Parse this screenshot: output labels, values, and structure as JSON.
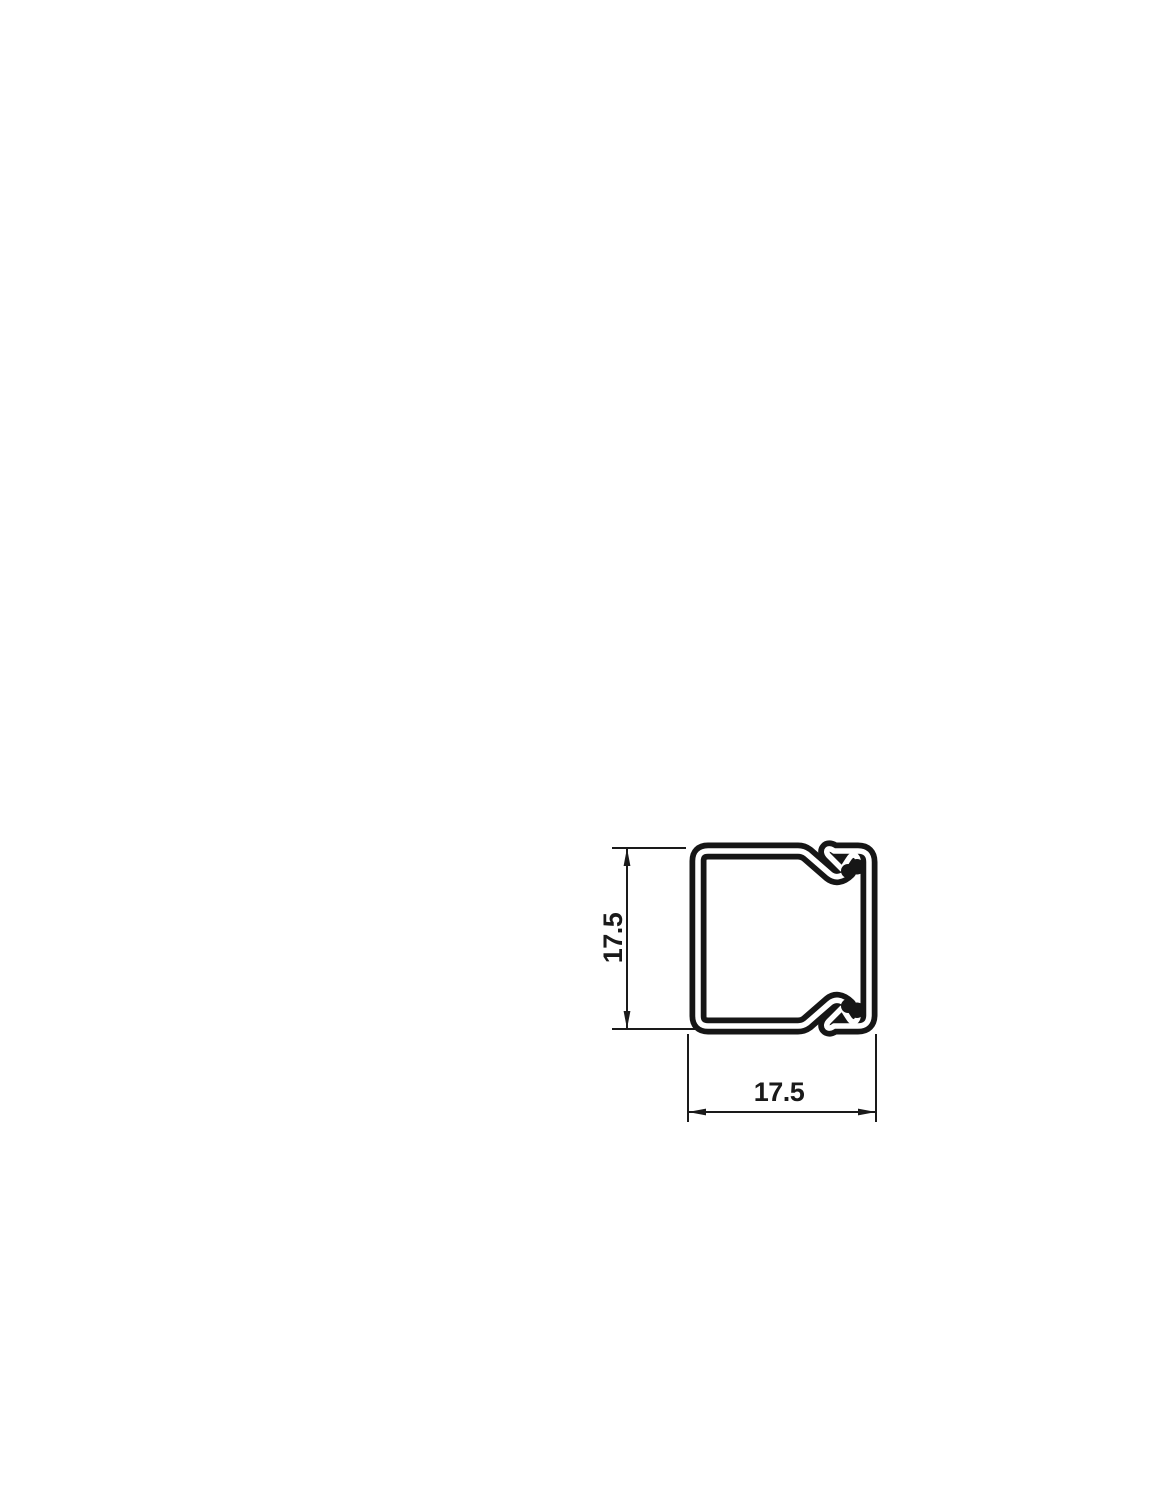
{
  "drawing": {
    "kind": "technical-cross-section",
    "height_dim": {
      "label": "17.5"
    },
    "width_dim": {
      "label": "17.5"
    },
    "colors": {
      "profile_line": "#161616",
      "dimension_line": "#1a1a1a",
      "background": "#ffffff"
    }
  }
}
